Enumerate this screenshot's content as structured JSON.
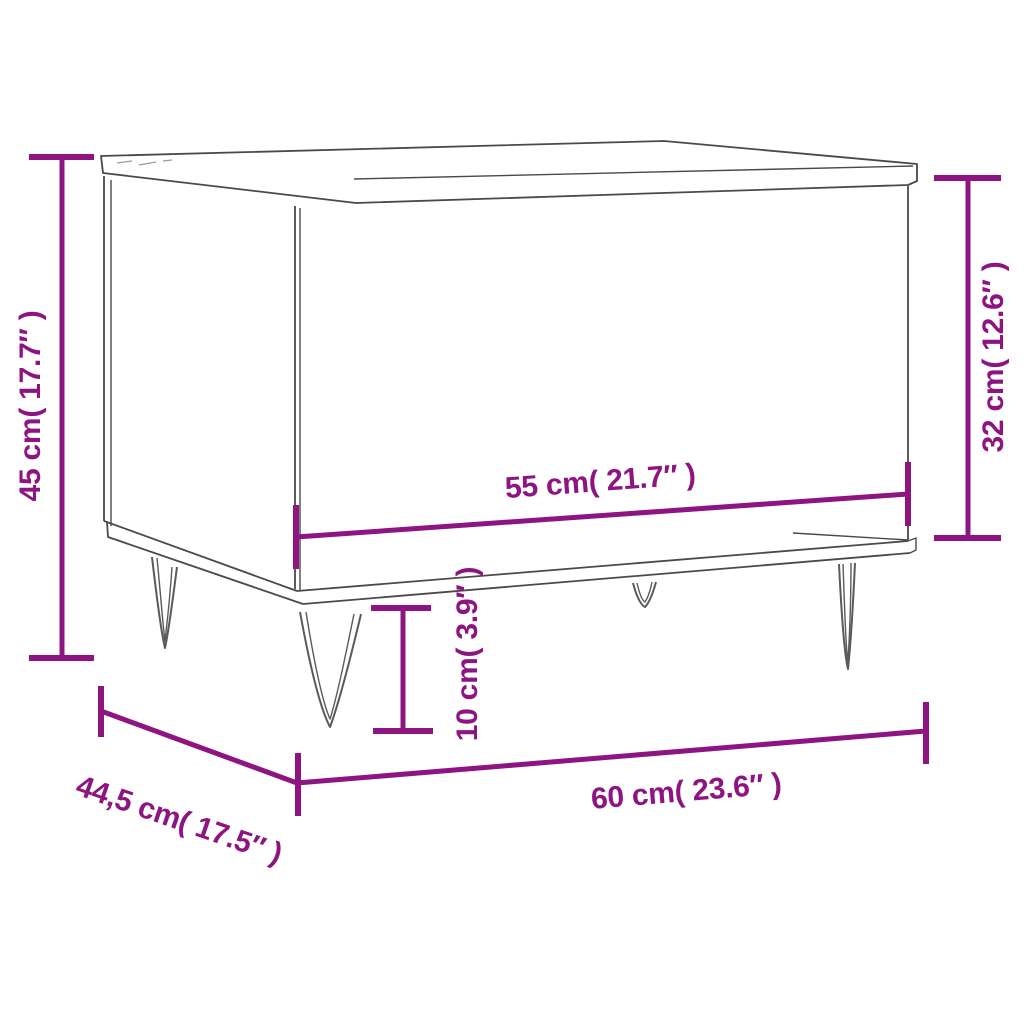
{
  "diagram": {
    "type": "furniture-dimension-diagram",
    "subject": "coffee table with hairpin legs",
    "background": "#ffffff",
    "colors": {
      "accent": "#8E1581",
      "line_art": "#4A4A4A",
      "leg_line": "#5A5A5A"
    },
    "dimensions": [
      {
        "id": "total-height",
        "label": "45 cm( 17.7″ )",
        "value_cm": "45",
        "value_inch": "17.7",
        "orientation": "vertical",
        "position": "left"
      },
      {
        "id": "body-height",
        "label": "32 cm( 12.6″ )",
        "value_cm": "32",
        "value_inch": "12.6",
        "orientation": "vertical",
        "position": "right"
      },
      {
        "id": "body-width",
        "label": "55 cm( 21.7″ )",
        "value_cm": "55",
        "value_inch": "21.7",
        "orientation": "horizontal",
        "position": "center"
      },
      {
        "id": "leg-height",
        "label": "10 cm( 3.9″ )",
        "value_cm": "10",
        "value_inch": "3.9",
        "orientation": "vertical",
        "position": "center-bottom"
      },
      {
        "id": "total-width",
        "label": "60 cm( 23.6″ )",
        "value_cm": "60",
        "value_inch": "23.6",
        "orientation": "horizontal",
        "position": "bottom"
      },
      {
        "id": "depth",
        "label": "44,5 cm( 17.5″ )",
        "value_cm": "44,5",
        "value_inch": "17.5",
        "orientation": "diagonal",
        "position": "bottom-left"
      }
    ]
  }
}
